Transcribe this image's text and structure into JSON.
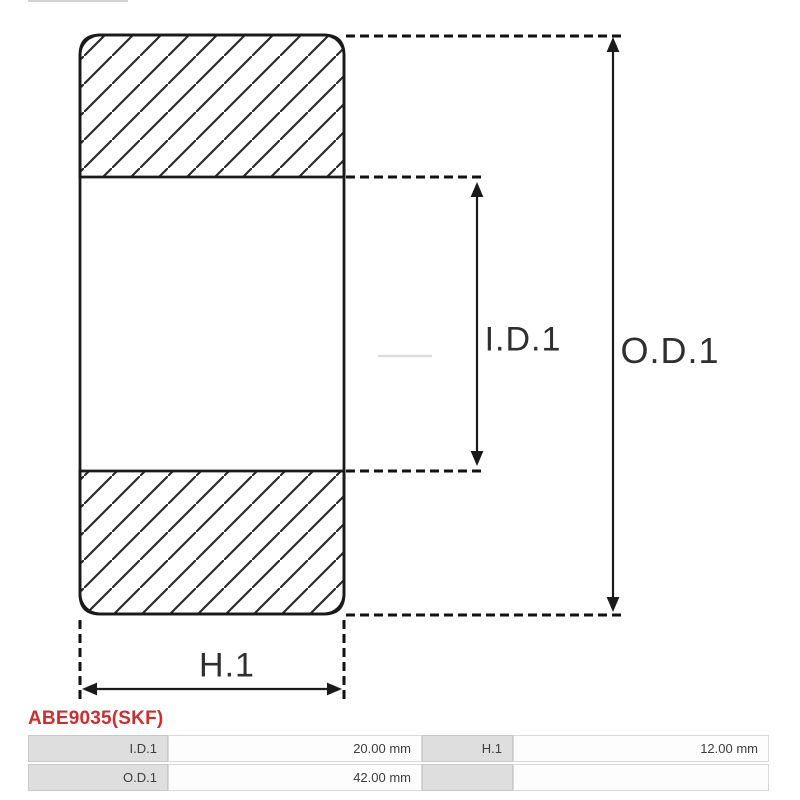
{
  "diagram": {
    "type": "bearing-cross-section",
    "line_color": "#1a1a1a",
    "dimension_labels": {
      "inner_diameter": "I.D.1",
      "outer_diameter": "O.D.1",
      "height": "H.1"
    }
  },
  "part": {
    "code": "ABE9035(SKF)",
    "code_color": "#cb2f2f"
  },
  "spec_table": {
    "label_bg": "#dedede",
    "cells": [
      {
        "label": "I.D.1",
        "value": "20.00 mm"
      },
      {
        "label": "H.1",
        "value": "12.00 mm"
      },
      {
        "label": "O.D.1",
        "value": "42.00 mm"
      },
      {
        "label": "",
        "value": ""
      }
    ]
  }
}
